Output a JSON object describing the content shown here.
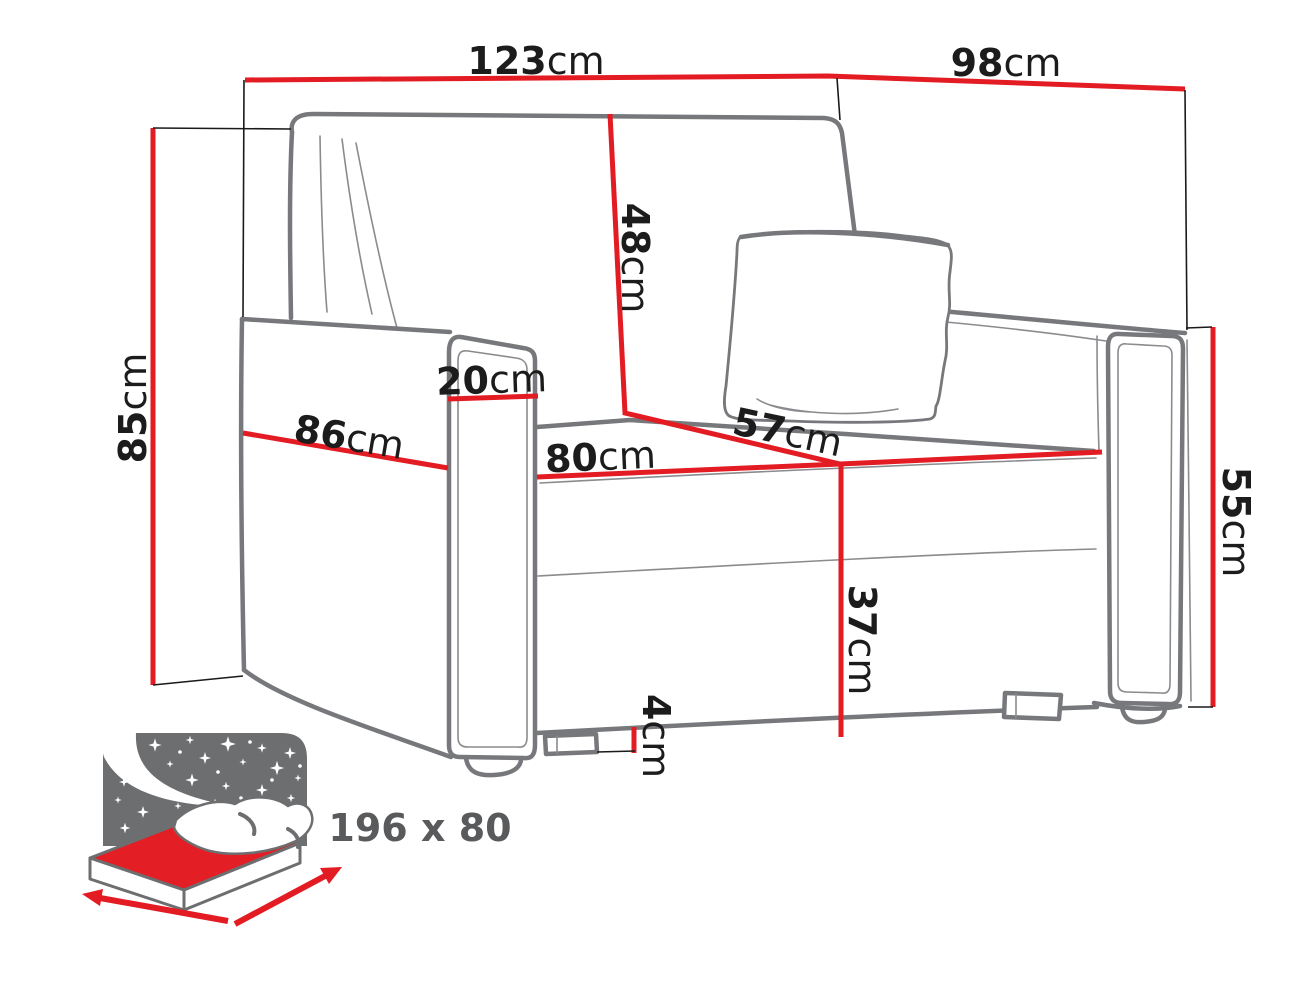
{
  "diagram": {
    "type": "sofa-dimension-drawing",
    "unit": "cm",
    "dimensions": {
      "overall_width": {
        "value": "123",
        "unit": "cm"
      },
      "overall_depth": {
        "value": "98",
        "unit": "cm"
      },
      "overall_height": {
        "value": "85",
        "unit": "cm"
      },
      "backrest_height": {
        "value": "48",
        "unit": "cm"
      },
      "armrest_width": {
        "value": "20",
        "unit": "cm"
      },
      "side_seat_depth": {
        "value": "86",
        "unit": "cm"
      },
      "seat_width": {
        "value": "80",
        "unit": "cm"
      },
      "seat_depth": {
        "value": "57",
        "unit": "cm"
      },
      "base_height": {
        "value": "37",
        "unit": "cm"
      },
      "leg_height": {
        "value": "4",
        "unit": "cm"
      },
      "armrest_height": {
        "value": "55",
        "unit": "cm"
      }
    },
    "sleeping_area": {
      "label": "196 x 80"
    },
    "colors": {
      "dimension_line": "#e31b22",
      "sofa_outline": "#77787b",
      "label_text": "#1c1c1c",
      "icon_gray": "#6d6e70",
      "icon_label_text": "#595a5c"
    }
  }
}
